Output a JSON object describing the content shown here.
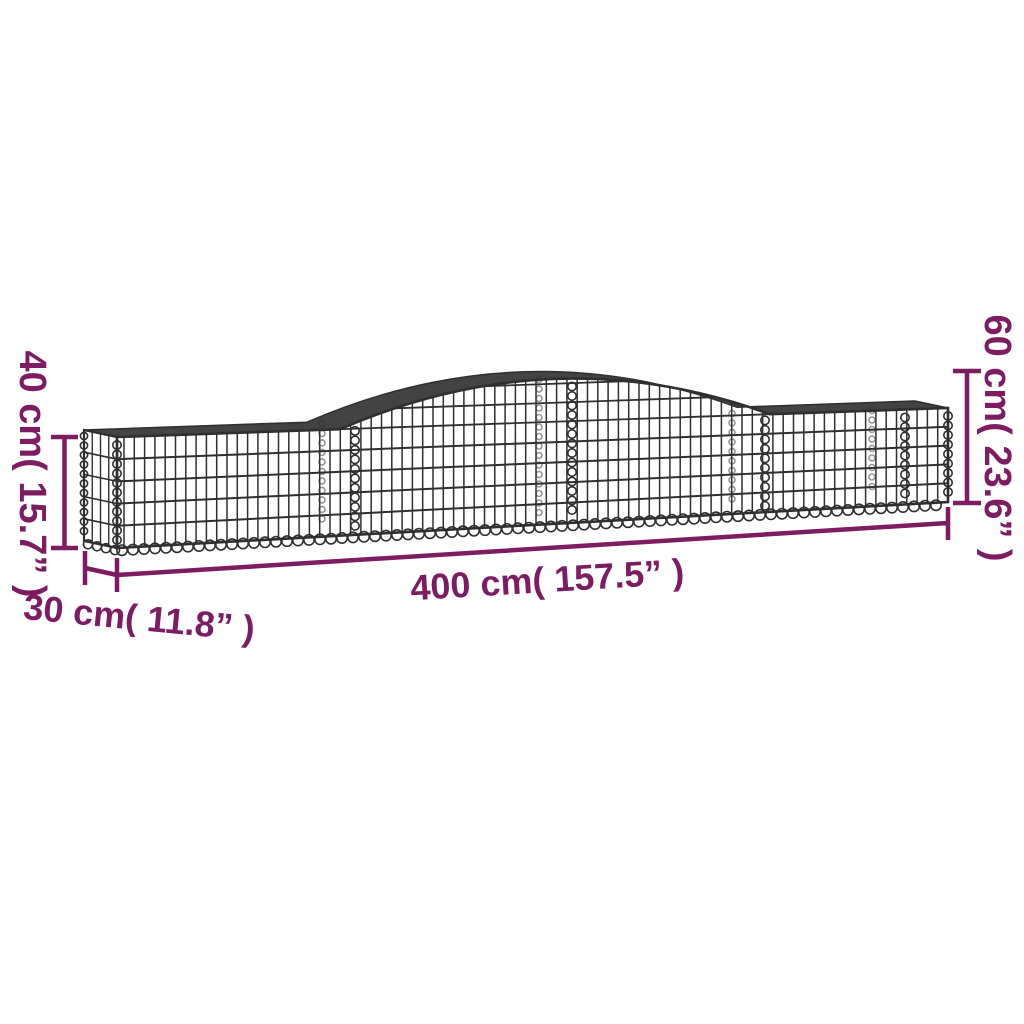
{
  "colors": {
    "accent": "#7d1c62",
    "wire": "#2f2f2f",
    "background": "#ffffff"
  },
  "dimension_labels": {
    "height_left": "40 cm( 15.7” )",
    "height_right": "60 cm( 23.6” )",
    "length": "400 cm( 157.5” )",
    "depth": "30 cm( 11.8” )"
  }
}
